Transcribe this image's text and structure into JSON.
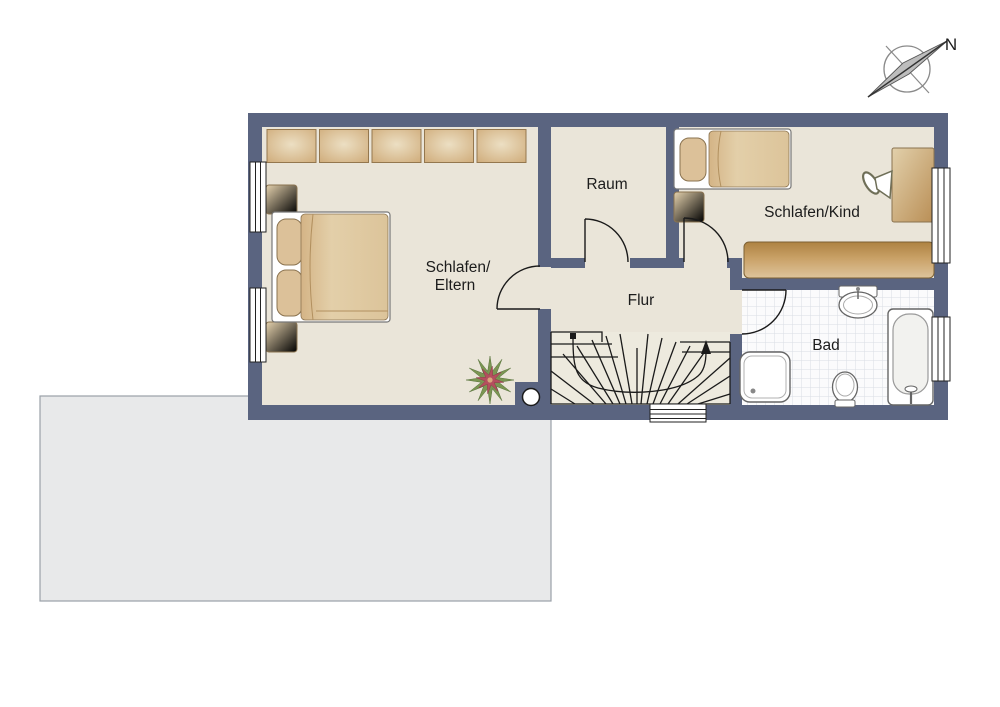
{
  "title": "Obergeschoss Grundriss (upper floor plan)",
  "compass": {
    "label": "N",
    "icon": "compass-rose-icon"
  },
  "rooms": {
    "parents_bedroom": {
      "label_line1": "Schlafen/",
      "label_line2": "Eltern"
    },
    "storage_room": {
      "label": "Raum"
    },
    "child_bedroom": {
      "label": "Schlafen/Kind"
    },
    "hallway": {
      "label": "Flur"
    },
    "bathroom": {
      "label": "Bad"
    }
  },
  "symbols": {
    "compass": "compass-rose-icon",
    "stairs": "winder-staircase-symbol",
    "plant": "plant-symbol",
    "column": "round-column-symbol",
    "windows": "triple-line-window-symbol",
    "doors": "quarter-arc-door-symbol"
  },
  "colors": {
    "wall": "#5a6480",
    "floor": "#eae5d9",
    "stair_floor": "#edeade",
    "furniture_tan": "#d3b184",
    "furniture_tan_light": "#e8d9bb",
    "furniture_border": "#8a7350",
    "sideboard_dark": "#b08545",
    "bathroom_tile": "#fbfbfc",
    "tile_grid": "#dadee4",
    "fixture_outline": "#666666",
    "lower_roof_gray": "#e8e9ea",
    "lower_roof_border": "#9aa0a8",
    "plant_green": "#7b9653",
    "plant_red": "#b44f5e",
    "line_black": "#1a1a1a"
  }
}
